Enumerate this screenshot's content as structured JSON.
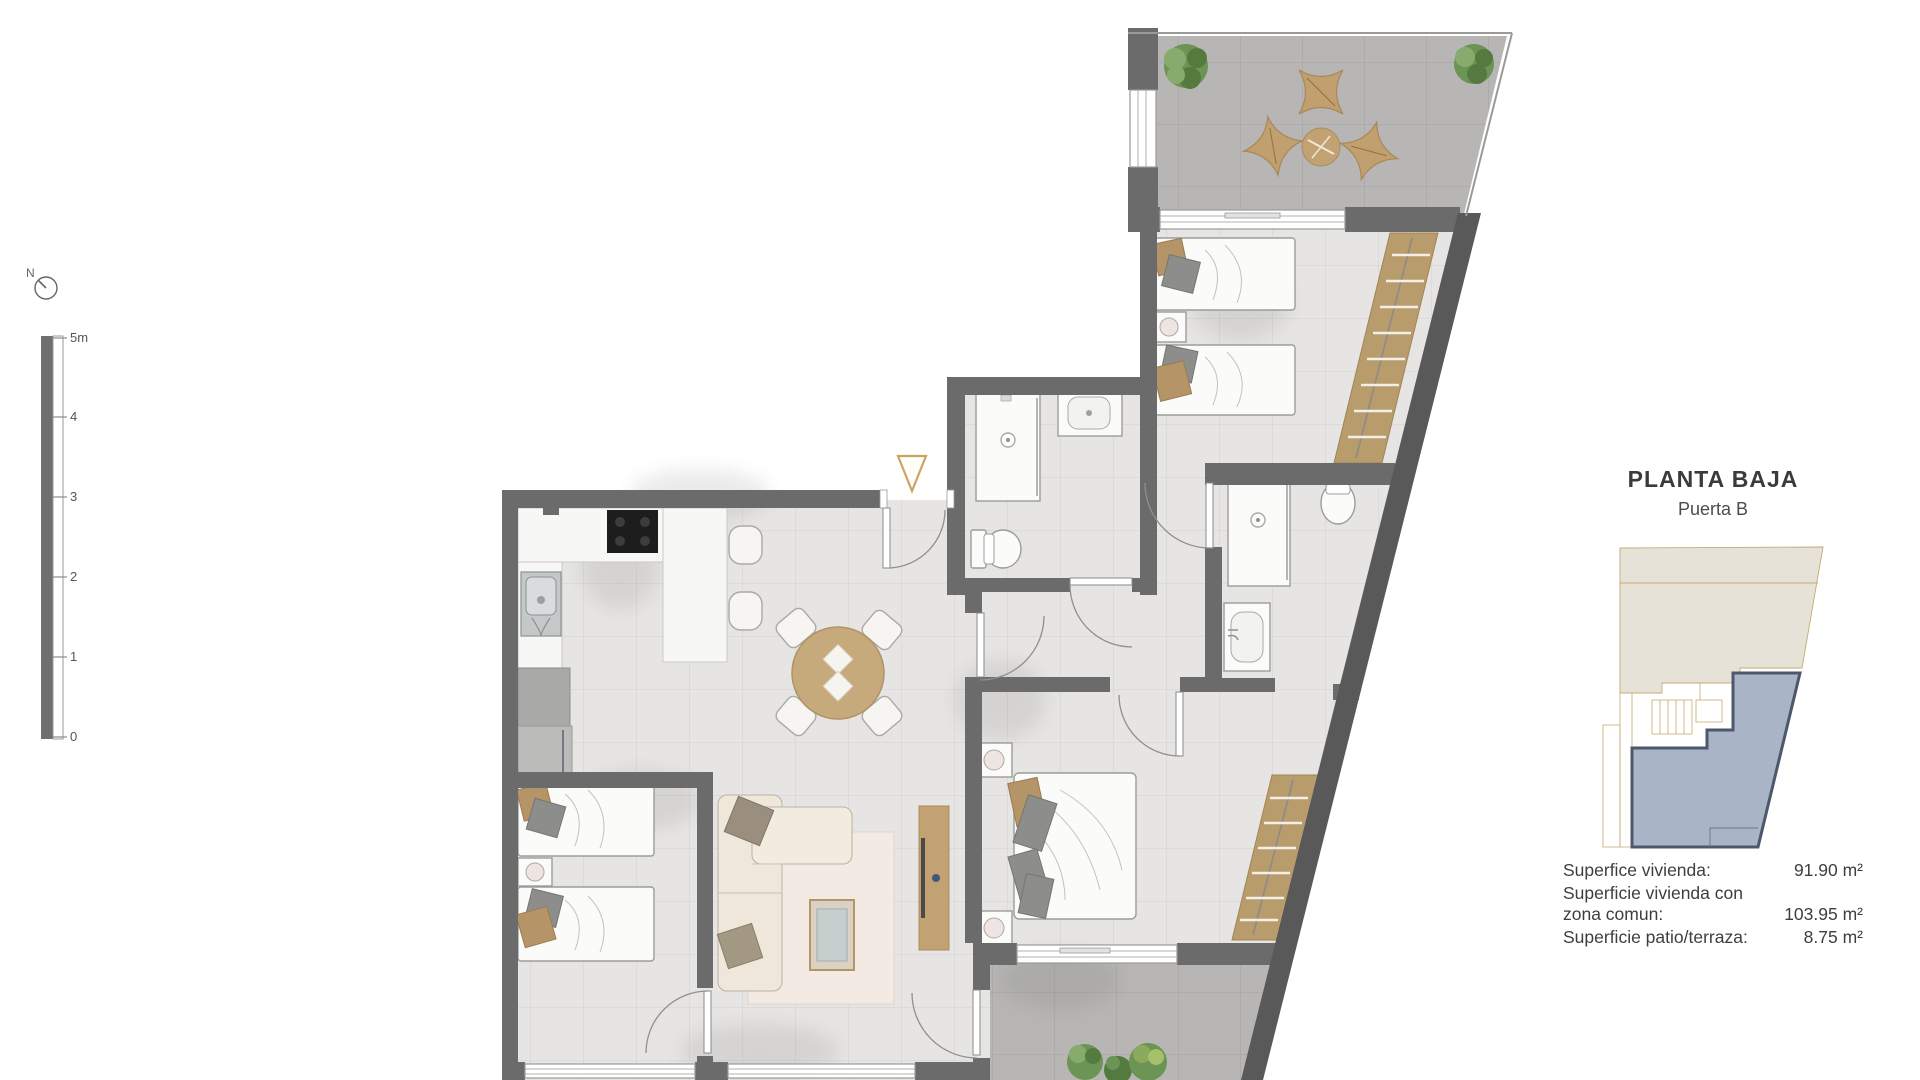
{
  "header": {
    "title": "PLANTA BAJA",
    "subtitle": "Puerta B"
  },
  "areas": {
    "rows": [
      {
        "label": "Superfice vivienda:",
        "value": "91.90 m²"
      },
      {
        "label": "Superficie vivienda con zona comun:",
        "value": "103.95 m²"
      },
      {
        "label": "Superficie patio/terraza:",
        "value": "8.75 m²"
      }
    ]
  },
  "compass": {
    "label": "N"
  },
  "scalebar": {
    "labels": [
      "5m",
      "4",
      "3",
      "2",
      "1",
      "0"
    ]
  },
  "colors": {
    "wall": "#6b6b6b",
    "floor": "#e6e5e3",
    "terrace": "#b7b6b4",
    "wood": "#c2a273",
    "gold_accent": "#c9a566",
    "keyplan_highlight_fill": "#aab4c7",
    "keyplan_highlight_stroke": "#4e586d",
    "keyplan_neighbor_fill": "#e7e2d8"
  }
}
